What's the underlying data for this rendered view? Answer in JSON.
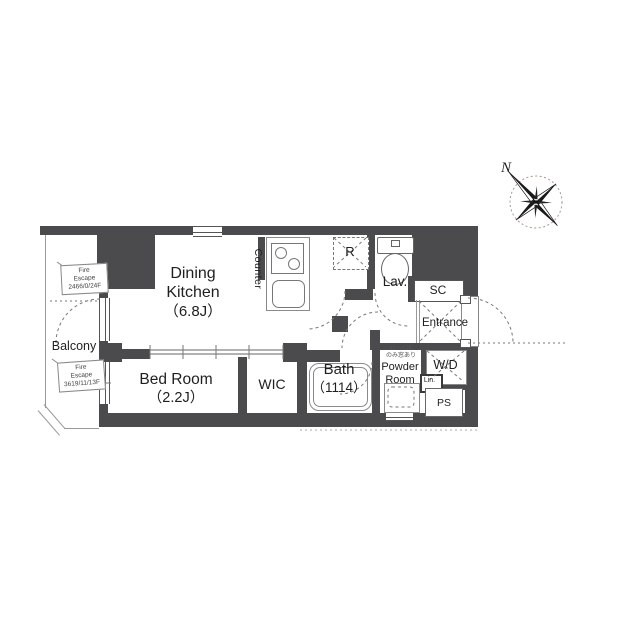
{
  "title": "apartment-floor-plan",
  "rooms": {
    "dining_kitchen": {
      "line1": "Dining",
      "line2": "Kitchen",
      "size": "（6.8J）"
    },
    "bed_room": {
      "name": "Bed Room",
      "size": "（2.2J）"
    },
    "wic": {
      "name": "WIC"
    },
    "bath": {
      "name": "Bath",
      "size": "（1114）"
    },
    "powder": {
      "line1": "Powder",
      "line2": "Room",
      "note1": "11〜13F",
      "note2": "のみ窓あり"
    },
    "wd": {
      "name": "W/D"
    },
    "lin": {
      "name": "Lin."
    },
    "ps": {
      "name": "PS"
    },
    "lav": {
      "name": "Lav."
    },
    "sc": {
      "name": "SC"
    },
    "entrance": {
      "name": "Entrance"
    },
    "balcony": {
      "name": "Balcony"
    },
    "counter": {
      "name": "Counter"
    },
    "fridge": {
      "name": "R"
    }
  },
  "annotations": {
    "fire_escape_1": {
      "l1": "Fire",
      "l2": "Escape",
      "l3": "2466/0/24F"
    },
    "fire_escape_2": {
      "l1": "Fire",
      "l2": "Escape",
      "l3": "3619/11/13F"
    },
    "compass_n": "N"
  },
  "colors": {
    "wall": "#4b4b4d",
    "line": "#8a8a8a",
    "thin": "#999999",
    "dash": "#777777",
    "text": "#1f1f1f",
    "sub": "#555555",
    "ring": "#a59890"
  }
}
